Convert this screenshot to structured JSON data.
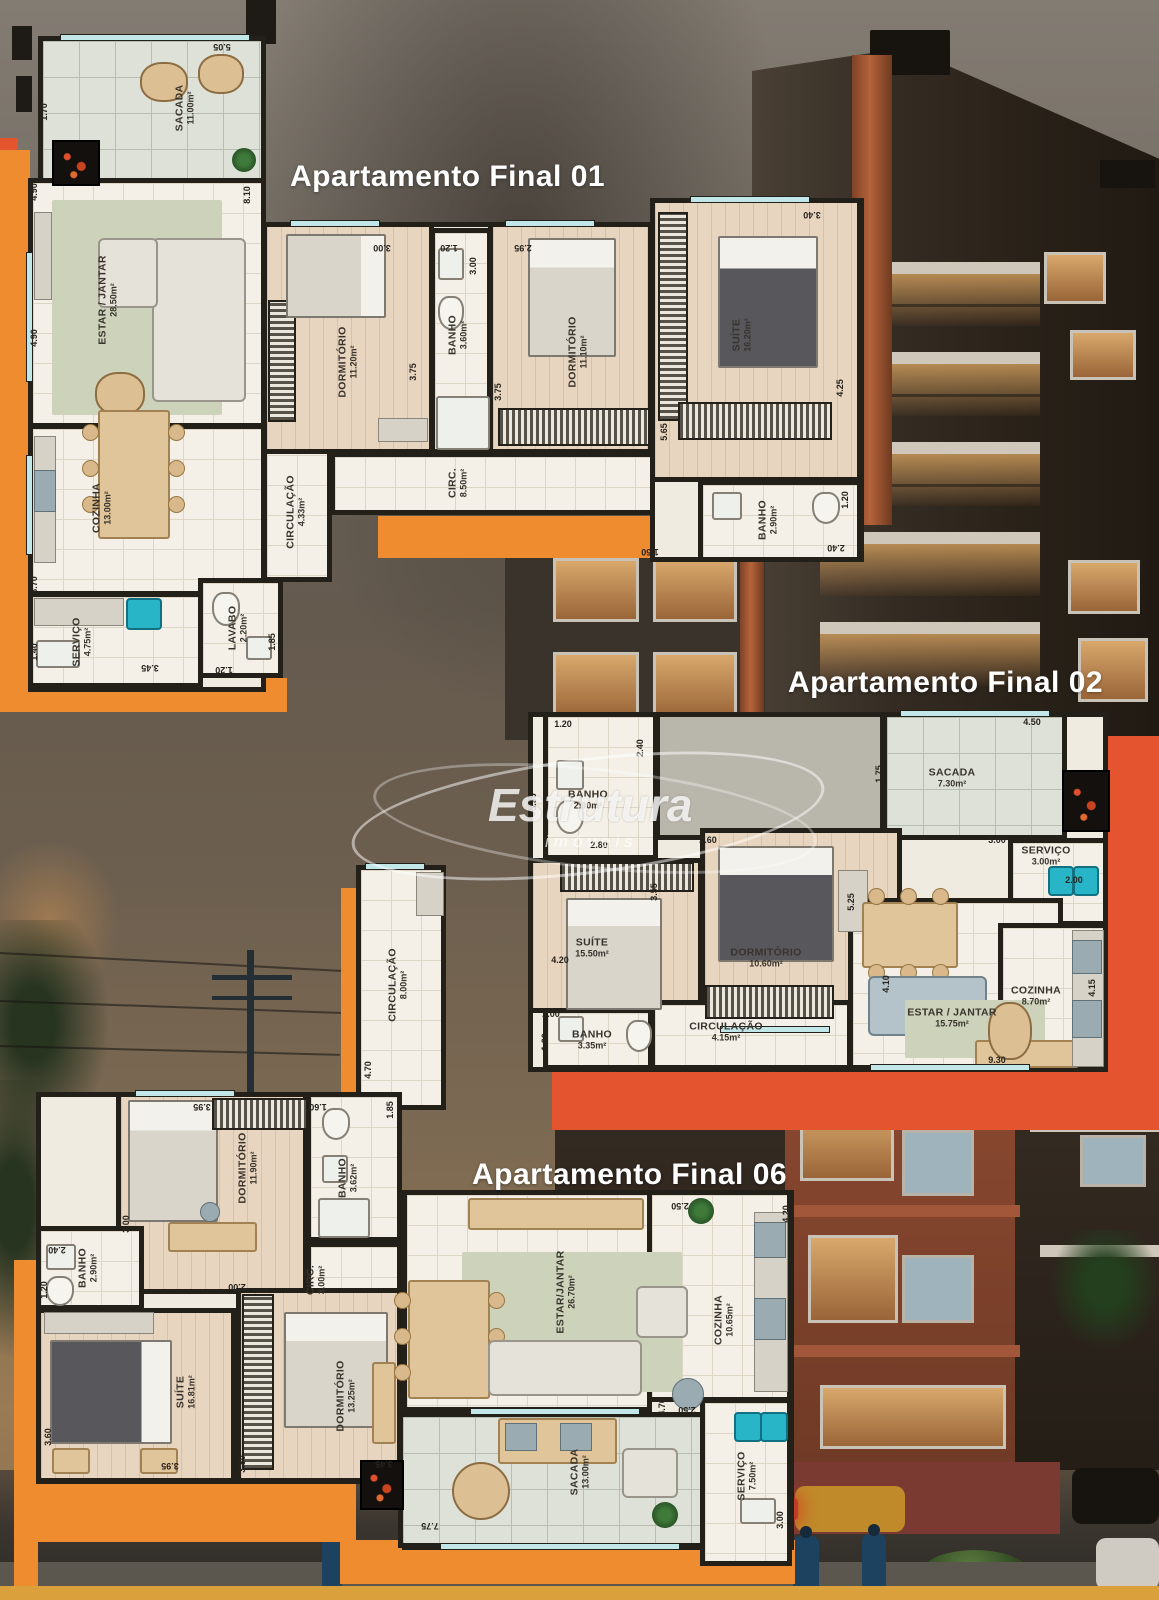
{
  "watermark": {
    "brand": "Estrutura",
    "sub": "imóveis"
  },
  "plan01": {
    "title": "Apartamento Final 01",
    "rooms": {
      "sacada": {
        "name": "SACADA",
        "area": "11.00m²"
      },
      "estar": {
        "name": "ESTAR / JANTAR",
        "area": "28.50m²"
      },
      "cozinha": {
        "name": "COZINHA",
        "area": "13.00m²"
      },
      "servico": {
        "name": "SERVIÇO",
        "area": "4.75m²"
      },
      "lavabo": {
        "name": "LAVABO",
        "area": "2.20m²"
      },
      "circulacao": {
        "name": "CIRCULAÇÃO",
        "area": "4.33m²"
      },
      "dorm1": {
        "name": "DORMITÓRIO",
        "area": "11.20m²"
      },
      "banho1": {
        "name": "BANHO",
        "area": "3.60m²"
      },
      "dorm2": {
        "name": "DORMITÓRIO",
        "area": "11.10m²"
      },
      "circ": {
        "name": "CIRC.",
        "area": "8.50m²"
      },
      "suite": {
        "name": "SUÍTE",
        "area": "16.20m²"
      },
      "banho2": {
        "name": "BANHO",
        "area": "2.90m²"
      }
    },
    "dims": [
      "5.05",
      "1.70",
      "8.10",
      "4.90",
      "4.90",
      "3.00",
      "1.20",
      "3.00",
      "2.95",
      "3.75",
      "3.75",
      "5.65",
      "3.40",
      "4.25",
      "1.20",
      "2.40",
      "1.50",
      "3.70",
      "1.40",
      "3.45",
      "1.20",
      "1.85"
    ]
  },
  "plan02": {
    "title": "Apartamento Final 02",
    "rooms": {
      "banho1": {
        "name": "BANHO",
        "area": "2.90m²"
      },
      "sacada": {
        "name": "SACADA",
        "area": "7.30m²"
      },
      "servico": {
        "name": "SERVIÇO",
        "area": "3.00m²"
      },
      "suite": {
        "name": "SUÍTE",
        "area": "15.50m²"
      },
      "dorm": {
        "name": "DORMITÓRIO",
        "area": "10.60m²"
      },
      "estar": {
        "name": "ESTAR / JANTAR",
        "area": "15.75m²"
      },
      "cozinha": {
        "name": "COZINHA",
        "area": "8.70m²"
      },
      "circulacao": {
        "name": "CIRCULAÇÃO",
        "area": "4.15m²"
      },
      "banho2": {
        "name": "BANHO",
        "area": "3.35m²"
      }
    },
    "dims": [
      "1.20",
      "2.40",
      "2.80",
      "3.90",
      "3.55",
      "2.60",
      "4.50",
      "1.75",
      "3.00",
      "2.00",
      "5.25",
      "4.20",
      "2.00",
      "1.20",
      "4.10",
      "4.15",
      "9.30"
    ]
  },
  "plan06": {
    "title": "Apartamento Final 06",
    "rooms": {
      "circulacao": {
        "name": "CIRCULAÇÃO",
        "area": "8.00m²"
      },
      "dorm1": {
        "name": "DORMITÓRIO",
        "area": "11.90m²"
      },
      "banho1": {
        "name": "BANHO",
        "area": "3.62m²"
      },
      "banho2": {
        "name": "BANHO",
        "area": "2.90m²"
      },
      "circ": {
        "name": "CIRC.",
        "area": "3.00m²"
      },
      "suite": {
        "name": "SUÍTE",
        "area": "16.81m²"
      },
      "dorm2": {
        "name": "DORMITÓRIO",
        "area": "13.25m²"
      },
      "estar": {
        "name": "ESTAR/JANTAR",
        "area": "26.70m²"
      },
      "cozinha": {
        "name": "COZINHA",
        "area": "10.65m²"
      },
      "sacada": {
        "name": "SACADA",
        "area": "13.00m²"
      },
      "servico": {
        "name": "SERVIÇO",
        "area": "7.50m²"
      }
    },
    "dims": [
      "4.70",
      "3.95",
      "1.60",
      "1.85",
      "3.00",
      "2.40",
      "1.20",
      "2.00",
      "3.60",
      "3.95",
      "3.80",
      "3.45",
      "5.70",
      "2.50",
      "4.20",
      "2.50",
      "4.70",
      "3.00",
      "7.75"
    ]
  }
}
